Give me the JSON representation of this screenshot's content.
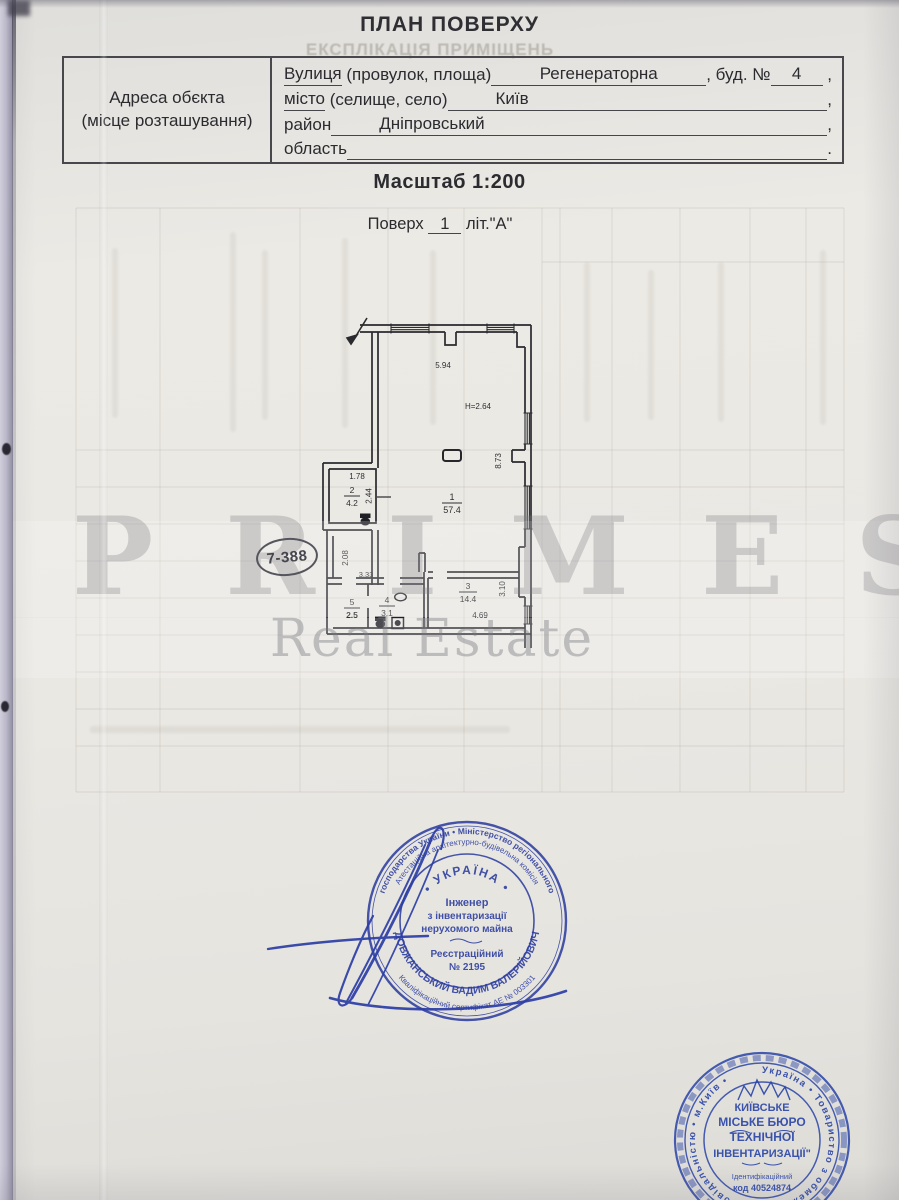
{
  "header": {
    "title": "ПЛАН ПОВЕРХУ",
    "bleed_title": "ЕКСПЛІКАЦІЯ ПРИМІЩЕНЬ",
    "scale_label": "Масштаб 1:200",
    "floor_prefix": "Поверх",
    "floor_value": "1",
    "floor_suffix": "літ.\"А\""
  },
  "address_table": {
    "left_label_line1": "Адреса обєкта",
    "left_label_line2": "(місце розташування)",
    "row1": {
      "label_u": "Вулиця",
      "label_rest": " (провулок, площа)",
      "value": "Регенераторна",
      "mid": ", буд. №",
      "value2": "4",
      "tail": " ,"
    },
    "row2": {
      "label_u": "місто",
      "label_rest": " (селище, село)",
      "value": "Київ",
      "tail": ","
    },
    "row3": {
      "label": "район",
      "value": "Дніпровський",
      "tail": ","
    },
    "row4": {
      "label": "область",
      "value": "",
      "tail": "."
    }
  },
  "plan": {
    "rooms": [
      {
        "num": "1",
        "area": "57.4"
      },
      {
        "num": "2",
        "area": "4.2"
      },
      {
        "num": "3",
        "area": "14.4"
      },
      {
        "num": "4",
        "area": "3.1"
      },
      {
        "num": "5",
        "area": "2.5"
      }
    ],
    "dims": {
      "top_width": "5.94",
      "height_note": "Н=2.64",
      "right_depth": "8.73",
      "room2_width": "1.78",
      "room2_depth": "2.44",
      "corridor_depth": "2.08",
      "corridor_width": "3.33",
      "room3_width": "4.69",
      "room3_depth": "3.10"
    }
  },
  "oval_stamp": {
    "code": "7-388"
  },
  "watermark": {
    "brand": "PRIMES",
    "line2": "Real Estate"
  },
  "engineer_seal": {
    "ring_top_outer": "господарства України  •  Міністерство регіонального",
    "ring_top_inner": "Атестаційна архітектурно-будівельна комісія",
    "country": "•  УКРАЇНА  •",
    "center_line1": "Інженер",
    "center_line2": "з інвентаризації",
    "center_line3": "нерухомого майна",
    "center_line4": "Реєстраційний",
    "center_line5": "№ 2195",
    "name_arc": "ДОВЖАНСЬКИЙ  ВАДИМ  ВАЛЕРІЙОВИЧ",
    "ring_bottom_outer": "Кваліфікаційний сертифікат АЕ № 003301"
  },
  "bti_stamp": {
    "ring": "Україна  •  Товариство з обмеженою відповідальністю  •  м.Київ  •",
    "center_line1": "КИЇВСЬКЕ",
    "center_line2": "МІСЬКЕ БЮРО",
    "center_line3": "ТЕХНІЧНОЇ",
    "center_line4": "ІНВЕНТАРИЗАЦІЇ\"",
    "center_line5": "Ідентифікаційний",
    "center_line6": "код 40524874"
  }
}
